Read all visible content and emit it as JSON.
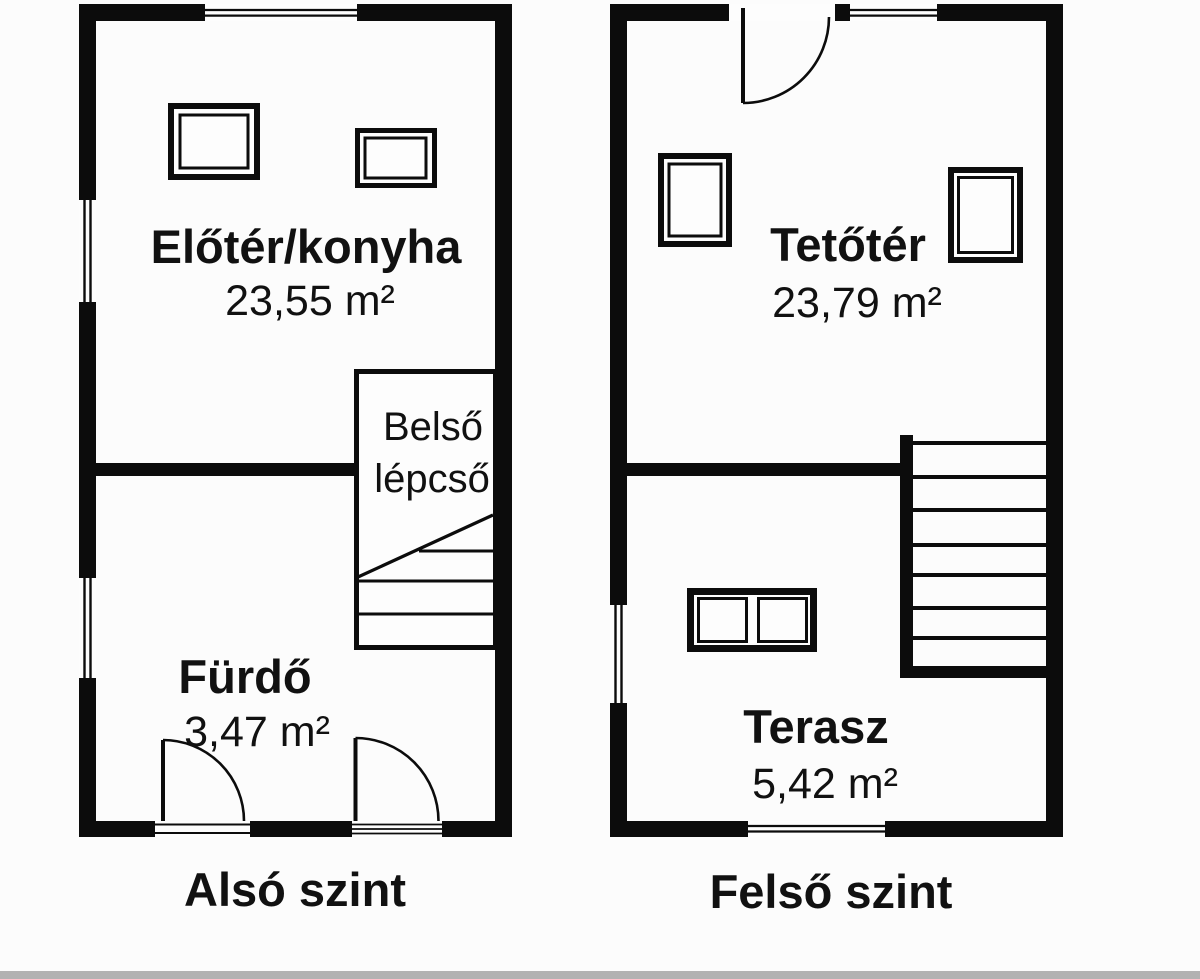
{
  "colors": {
    "background": "#fcfcfc",
    "line": "#0c0c0c",
    "footer_bar": "#b2b2b2"
  },
  "plans": {
    "lower": {
      "caption": "Alsó szint",
      "room_kitchen": {
        "name": "Előtér/konyha",
        "area": "23,55 m²"
      },
      "room_bath": {
        "name": "Fürdő",
        "area": "3,47 m²"
      },
      "stairs": {
        "line1": "Belső",
        "line2": "lépcső"
      }
    },
    "upper": {
      "caption": "Felső szint",
      "room_attic": {
        "name": "Tetőtér",
        "area": "23,79 m²"
      },
      "room_terrace": {
        "name": "Terasz",
        "area": "5,42 m²"
      }
    }
  }
}
